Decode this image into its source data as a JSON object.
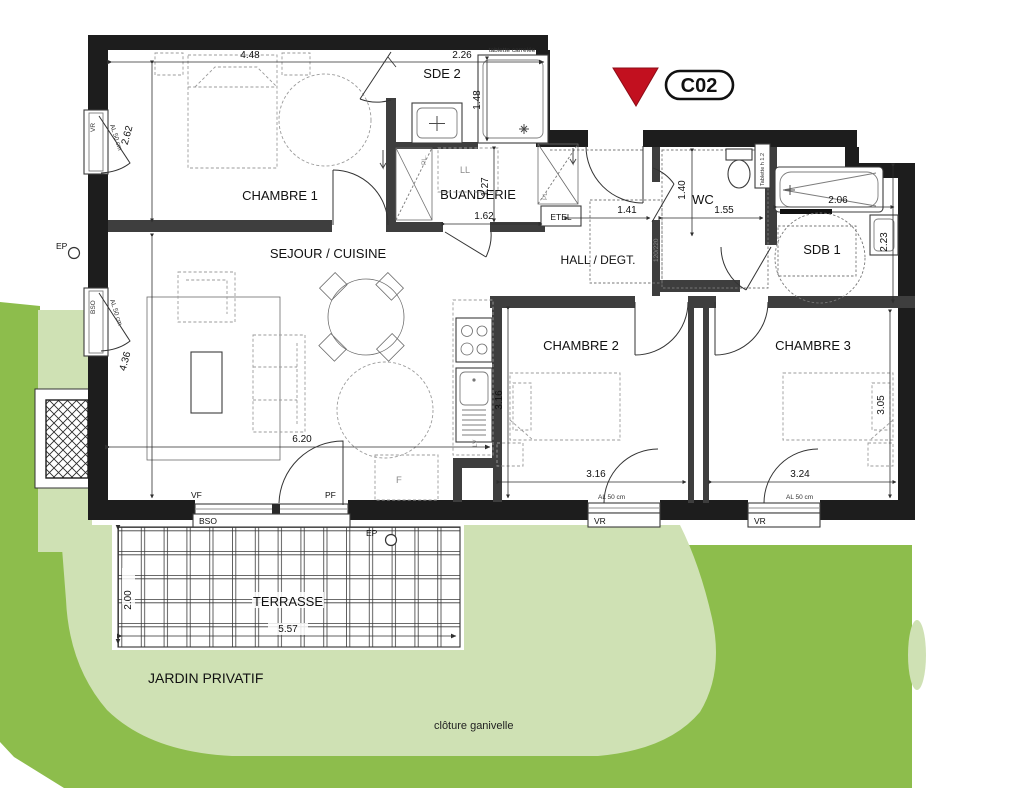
{
  "unit": {
    "code": "C02"
  },
  "rooms": {
    "chambre1": {
      "name": "CHAMBRE 1"
    },
    "sde2": {
      "name": "SDE 2"
    },
    "buanderie": {
      "name": "BUANDERIE"
    },
    "sejour": {
      "name": "SEJOUR / CUISINE"
    },
    "hall": {
      "name": "HALL / DEGT."
    },
    "wc": {
      "name": "WC"
    },
    "sdb1": {
      "name": "SDB 1"
    },
    "chambre2": {
      "name": "CHAMBRE 2"
    },
    "chambre3": {
      "name": "CHAMBRE 3"
    },
    "terrasse": {
      "name": "TERRASSE"
    },
    "jardin": {
      "name": "JARDIN PRIVATIF"
    }
  },
  "dimensions": {
    "chambre1_w": "4.48",
    "chambre1_h": "2.62",
    "sde2_w": "2.26",
    "sde2_h": "1.48",
    "buanderie_h": "1.27",
    "buanderie_w": "1.62",
    "sejour_w": "6.20",
    "sejour_h": "4.36",
    "hall_w": "1.41",
    "wc_w": "1.55",
    "wc_h": "1.40",
    "sdb1_w": "2.06",
    "sdb1_h": "2.23",
    "chambre2_h": "3.16",
    "chambre2_w": "3.16",
    "chambre3_w": "3.24",
    "chambre3_h": "3.05",
    "terrasse_w": "5.57",
    "terrasse_h": "2.00",
    "hall_door": "120/220"
  },
  "labels": {
    "vr": "VR",
    "bso": "BSO",
    "vf": "VF",
    "pf": "PF",
    "ep": "EP",
    "etel": "ETEL",
    "ll": "LL",
    "lv": "LV",
    "f": "F",
    "pl": "PL.",
    "al50": "AL 50 cm",
    "tablette_wc": "Tablette h 1.2",
    "tablette_sde": "tablette carrelée",
    "cloture": "clôture ganivelle"
  },
  "colors": {
    "garden_dark": "#8dbd4c",
    "garden_light": "#cfe1b4",
    "marker_red": "#c2101f",
    "wall": "#1d1d1d"
  }
}
